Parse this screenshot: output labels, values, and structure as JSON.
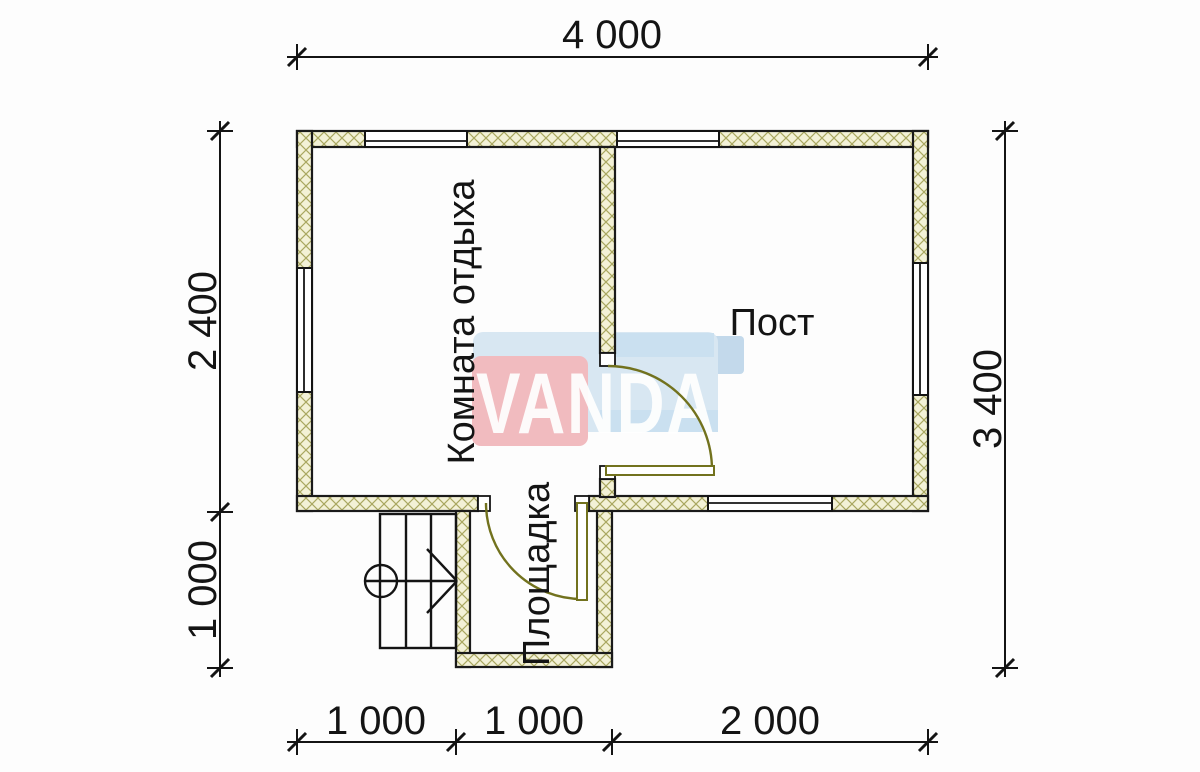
{
  "dimensions": {
    "top": "4 000",
    "left_upper": "2 400",
    "left_lower": "1 000",
    "right": "3 400",
    "bottom_left": "1 000",
    "bottom_middle": "1 000",
    "bottom_right": "2 000"
  },
  "rooms": {
    "rest_room": "Комната отдыха",
    "post": "Пост",
    "platform": "Площадка"
  },
  "watermark": {
    "text": "VANDA",
    "red": "#f0b0b5",
    "blue_light": "#d2e4f1",
    "blue_dark": "#b9d3e8",
    "blue_mid": "#c2dcee"
  },
  "colors": {
    "wall_fill": "#f3f1d6",
    "wall_hatch": "#a9a760",
    "door": "#72721e",
    "line": "#141414"
  }
}
